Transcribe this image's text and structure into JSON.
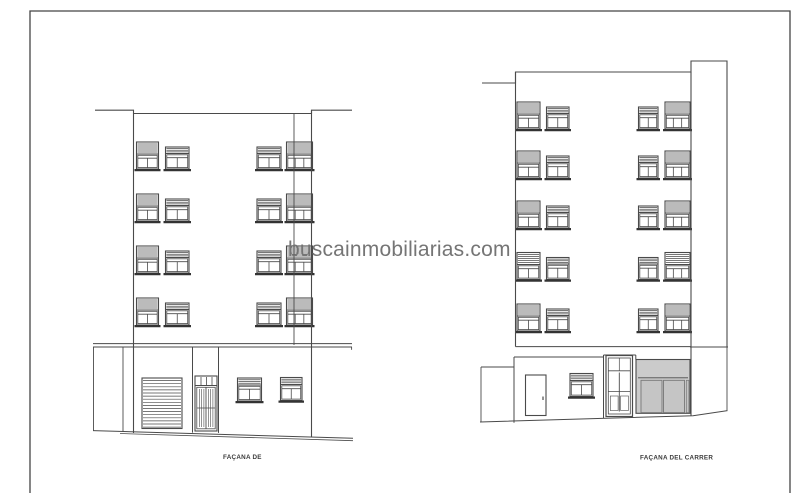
{
  "watermark": {
    "text": "buscainmobiliarias.com",
    "color": "#757575"
  },
  "drawing": {
    "left_facade": {
      "label": "FAÇANA DE",
      "floors": 5,
      "upper_window_rows": 4,
      "windows_per_row": 4
    },
    "right_facade": {
      "label": "FAÇANA DEL CARRER",
      "floors": 6,
      "upper_window_rows": 5,
      "windows_per_row": 4
    },
    "label_color": "#3a3a3a"
  },
  "colors": {
    "background": "#ffffff",
    "line": "#4a4a4a",
    "line_dark": "#333333",
    "frame": "#444444",
    "garage_fill": "#cbcbcb",
    "door_leaf_fill": "#c5c5c5",
    "door_leaf_stroke": "#777777"
  }
}
